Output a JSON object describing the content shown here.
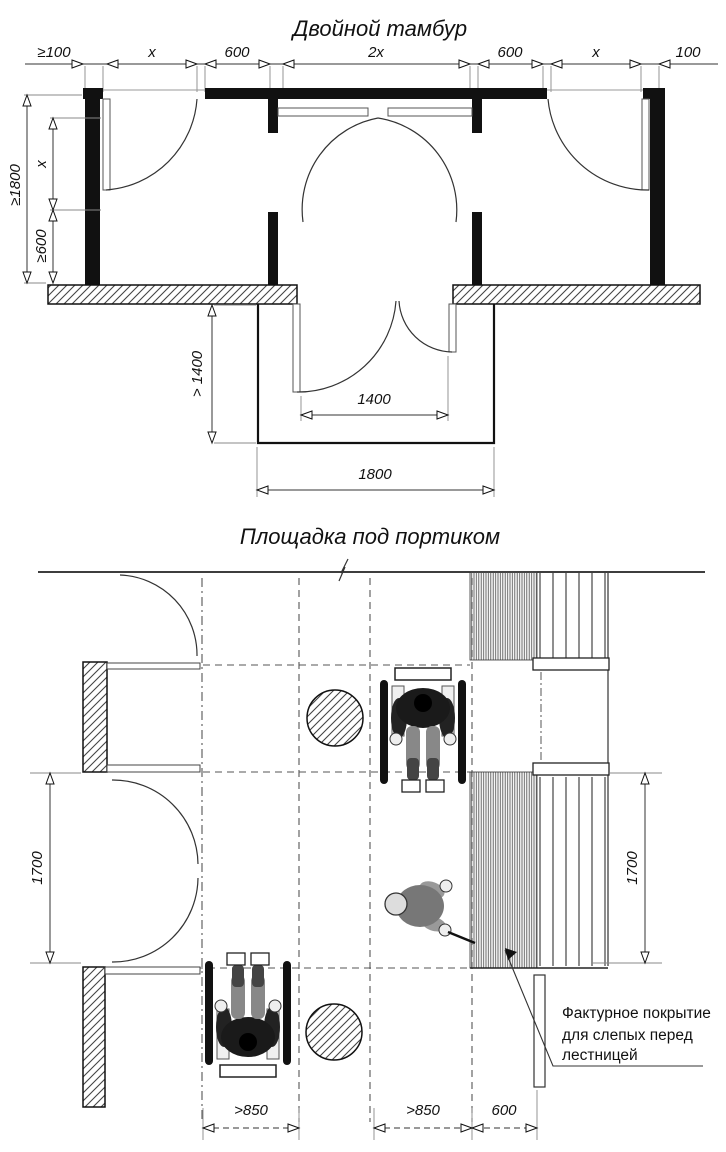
{
  "colors": {
    "ink": "#111111",
    "line": "#333333",
    "gray_ext": "#888888",
    "paper": "#ffffff"
  },
  "top_diagram": {
    "title": "Двойной тамбур",
    "dim_chain": [
      "≥100",
      "x",
      "600",
      "2x",
      "600",
      "x",
      "100"
    ],
    "dim_left_outer": "≥1800",
    "dim_left_upper": "x",
    "dim_left_lower": "≥600",
    "dim_depth": "> 1400",
    "dim_inner_door": "1400",
    "dim_outer_width": "1800"
  },
  "bottom_diagram": {
    "title": "Площадка под портиком",
    "dim_left": "1700",
    "dim_right": "1700",
    "dim_lane_left": ">850",
    "dim_lane_right": ">850",
    "dim_tactile": "600",
    "annotation_line1": "Фактурное покрытие",
    "annotation_line2": "для слепых перед",
    "annotation_line3": "лестницей"
  }
}
